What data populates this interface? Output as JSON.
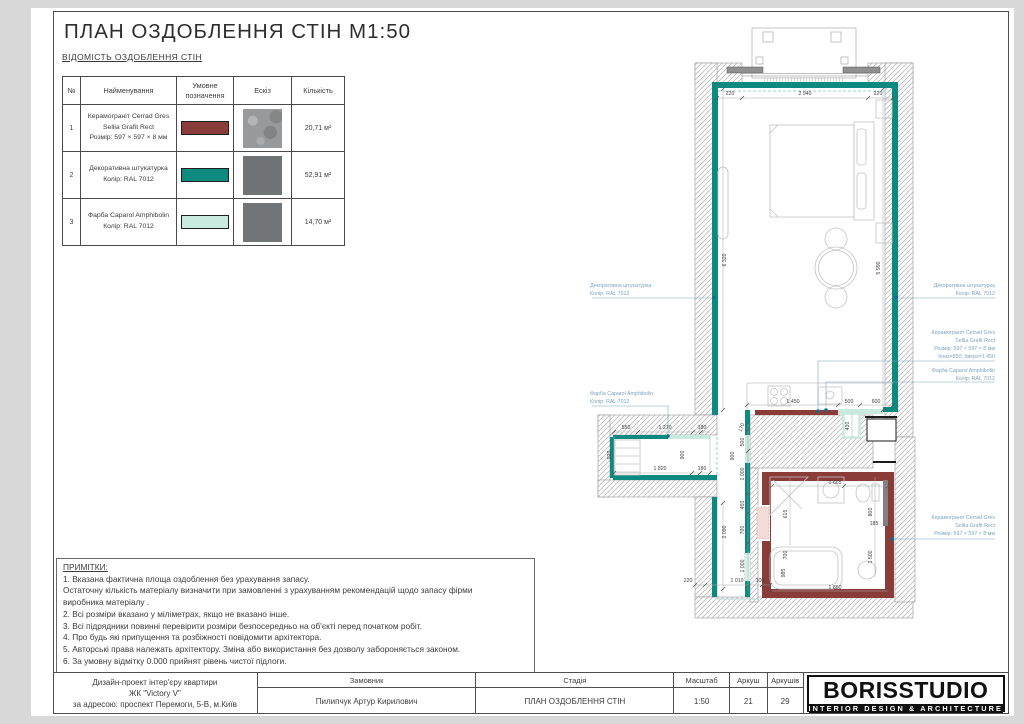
{
  "colors": {
    "teal": "#0d8a80",
    "red": "#8a3c39",
    "mint": "#c8e9dd",
    "anno": "#7fa3c0",
    "dot": "#0d6e8c",
    "sketch2": "#6f7376",
    "sketch3": "#717577"
  },
  "page": {
    "title": "ПЛАН ОЗДОБЛЕННЯ СТІН М1:50",
    "table_title": "ВІДОМІСТЬ ОЗДОБЛЕННЯ СТІН"
  },
  "finish_table": {
    "headers": {
      "num": "№",
      "name": "Найменування",
      "symbol": "Умовне позначення",
      "sketch": "Ескіз",
      "qty": "Кількість"
    },
    "rows": [
      {
        "num": "1",
        "swatch": "#8a3c39",
        "qty": "20,71 м²",
        "name_lines": [
          "Керамограніт Cerrad Gres",
          "Sellia Grafit Rect",
          "Розмір: 597 × 597 × 8 мм"
        ]
      },
      {
        "num": "2",
        "swatch": "#0d8a80",
        "qty": "52,91 м²",
        "name_lines": [
          "Декоративна штукатурка",
          "Колір: RAL 7012"
        ]
      },
      {
        "num": "3",
        "swatch": "#c8ebdf",
        "qty": "14,70 м²",
        "name_lines": [
          "Фарба Caparol Amphibolin",
          "Колір: RAL 7012"
        ]
      }
    ]
  },
  "notes": {
    "title": "ПРИМІТКИ:",
    "lines": [
      "1.  Вказана фактична площа оздоблення без урахування запасу.",
      "Остаточну кількість матеріалу визначити при замовленні з урахуванням рекомендацій щодо запасу фірми",
      "виробника матеріалу .",
      "2. Всі розміри вказано у міліметрах, якщо не вказано інше.",
      "3. Всі підрядники повинні перевірити розміри безпосередньо на об'єкті перед початком робіт.",
      "4. Про будь які припущення та розбіжності повідомити архітектора.",
      "5. Авторські права належать архітектору. Зміна або використання без дозволу забороняється законом.",
      "6. За умовну відмітку 0.000 прийнят рівень чистої підлоги."
    ]
  },
  "titleblock": {
    "project_lines": [
      "Дизайн-проект інтер'єру квартири",
      "ЖК \"Victory V\"",
      "за адресою: проспект Перемоги, 5-В, м.Київ"
    ],
    "customer_label": "Замовник",
    "customer": "Пилипчук Артур Кирилович",
    "stage_label": "Стадія",
    "stage": "ПЛАН ОЗДОБЛЕННЯ СТІН",
    "scale_label": "Масштаб",
    "scale": "1:50",
    "sheet_label": "Аркуш",
    "sheet": "21",
    "sheets_label": "Аркушів",
    "sheets": "29",
    "logo": "BORISSTUDIO",
    "logo_sub": "INTERIOR DESIGN & ARCHITECTURE"
  },
  "plan": {
    "dims": [
      "220",
      "2 940",
      "220",
      "6 320",
      "5 990",
      "1 450",
      "500",
      "600",
      "430",
      "170",
      "500",
      "1 000",
      "450",
      "700",
      "1 000",
      "550",
      "1 270",
      "180",
      "920",
      "900",
      "1 820",
      "180",
      "900",
      "2 090",
      "220",
      "1 010",
      "100",
      "1 665",
      "615",
      "800",
      "700",
      "185",
      "1 500",
      "985",
      "1 850"
    ],
    "annotations": {
      "left1": {
        "lines": [
          "Декоративна штукатурка",
          "Колір: RAL 7012"
        ]
      },
      "left2": {
        "lines": [
          "Фарба Caparol Amphibolin",
          "Колір: RAL 7012"
        ]
      },
      "right1": {
        "lines": [
          "Декоративна штукатурка",
          "Колір: RAL 7012"
        ]
      },
      "right2": {
        "lines": [
          "Керамограніт Cerrad Gres",
          "Sellia Grafit Rect",
          "Розмір: 597 × 597 × 8 мм",
          "hниз=850, hверх=1 450"
        ]
      },
      "right3": {
        "lines": [
          "Фарба Caparol Amphibolin",
          "Колір: RAL 7012"
        ]
      },
      "right4": {
        "lines": [
          "Керамограніт Cerrad Gres",
          "Sellia Grafit Rect",
          "Розмір: 597 × 597 × 8 мм"
        ]
      }
    }
  }
}
